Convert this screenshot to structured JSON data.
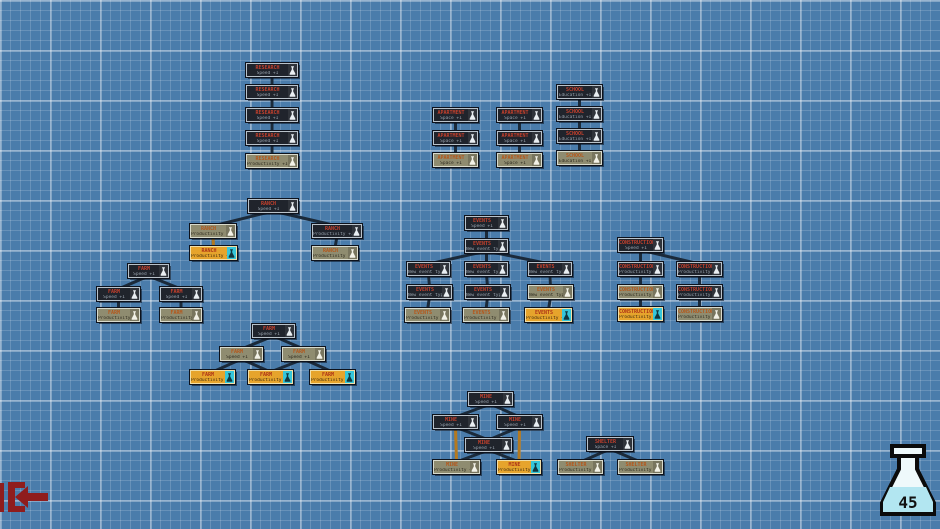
{
  "hud": {
    "science_count": "45",
    "science_icon": "flask-icon",
    "exit_icon": "exit-bracket-arrow-icon"
  },
  "palette": {
    "background_blue": "#4a7cab",
    "grid_line": "#7fa9cd",
    "node_dark_bg": "#20242c",
    "node_tan_bg": "#8f8c70",
    "node_yellow_bg": "#e6a42c",
    "node_title_red": "#c4402c",
    "node_title_orange": "#b5571a",
    "edge_dark": "#1b2a3a",
    "edge_orange": "#b5791f",
    "flask_liquid_cyan": "#b2e6f1",
    "exit_red": "#8f1d1d"
  },
  "tree": {
    "nodes": [
      {
        "id": "r1",
        "x": 246,
        "y": 63,
        "w": 52,
        "state": "dark",
        "label": "RESEARCH",
        "sub": "Speed +1"
      },
      {
        "id": "r2",
        "x": 246,
        "y": 85,
        "w": 52,
        "state": "dark",
        "label": "RESEARCH",
        "sub": "Speed +1"
      },
      {
        "id": "r3",
        "x": 246,
        "y": 108,
        "w": 52,
        "state": "dark",
        "label": "RESEARCH",
        "sub": "Speed +1"
      },
      {
        "id": "r4",
        "x": 246,
        "y": 131,
        "w": 52,
        "state": "dark",
        "label": "RESEARCH",
        "sub": "Speed +1"
      },
      {
        "id": "r5",
        "x": 246,
        "y": 154,
        "w": 52,
        "state": "tan",
        "label": "RESEARCH",
        "sub": "Productivity +10%"
      },
      {
        "id": "a1",
        "x": 433,
        "y": 108,
        "w": 45,
        "state": "dark",
        "label": "APARTMENT",
        "sub": "Space +1"
      },
      {
        "id": "a2",
        "x": 433,
        "y": 131,
        "w": 45,
        "state": "dark",
        "label": "APARTMENT",
        "sub": "Space +1"
      },
      {
        "id": "a3",
        "x": 433,
        "y": 153,
        "w": 45,
        "state": "tan",
        "label": "APARTMENT",
        "sub": "Space +1"
      },
      {
        "id": "b1",
        "x": 497,
        "y": 108,
        "w": 45,
        "state": "dark",
        "label": "APARTMENT",
        "sub": "Space +1"
      },
      {
        "id": "b2",
        "x": 497,
        "y": 131,
        "w": 45,
        "state": "dark",
        "label": "APARTMENT",
        "sub": "Space +1"
      },
      {
        "id": "b3",
        "x": 497,
        "y": 153,
        "w": 45,
        "state": "tan",
        "label": "APARTMENT",
        "sub": "Space +1"
      },
      {
        "id": "s1",
        "x": 557,
        "y": 85,
        "w": 45,
        "state": "dark",
        "label": "SCHOOL",
        "sub": "Education +1"
      },
      {
        "id": "s2",
        "x": 557,
        "y": 107,
        "w": 45,
        "state": "dark",
        "label": "SCHOOL",
        "sub": "Education +1"
      },
      {
        "id": "s3",
        "x": 557,
        "y": 129,
        "w": 45,
        "state": "dark",
        "label": "SCHOOL",
        "sub": "Education +1"
      },
      {
        "id": "s4",
        "x": 557,
        "y": 151,
        "w": 45,
        "state": "tan",
        "label": "SCHOOL",
        "sub": "Education +1"
      },
      {
        "id": "rc1",
        "x": 248,
        "y": 199,
        "w": 50,
        "state": "dark",
        "label": "RANCH",
        "sub": "Speed +1"
      },
      {
        "id": "rc2",
        "x": 190,
        "y": 224,
        "w": 46,
        "state": "tan",
        "label": "RANCH",
        "sub": "Productivity +10%"
      },
      {
        "id": "rc3",
        "x": 190,
        "y": 246,
        "w": 47,
        "state": "yellow",
        "label": "RANCH",
        "sub": "Productivity +25%"
      },
      {
        "id": "rc4",
        "x": 312,
        "y": 224,
        "w": 50,
        "state": "dark",
        "label": "RANCH",
        "sub": "Productivity +10%"
      },
      {
        "id": "rc5",
        "x": 312,
        "y": 246,
        "w": 46,
        "state": "tan",
        "label": "RANCH",
        "sub": "Productivity +10%"
      },
      {
        "id": "f1",
        "x": 128,
        "y": 264,
        "w": 41,
        "state": "dark",
        "label": "FARM",
        "sub": "Speed +1"
      },
      {
        "id": "f2",
        "x": 97,
        "y": 287,
        "w": 43,
        "state": "dark",
        "label": "FARM",
        "sub": "Speed +1"
      },
      {
        "id": "f3",
        "x": 160,
        "y": 287,
        "w": 42,
        "state": "dark",
        "label": "FARM",
        "sub": "Speed +1"
      },
      {
        "id": "f4",
        "x": 97,
        "y": 308,
        "w": 43,
        "state": "tan",
        "label": "FARM",
        "sub": "Productivity +10%"
      },
      {
        "id": "f5",
        "x": 160,
        "y": 308,
        "w": 42,
        "state": "tan",
        "label": "FARM",
        "sub": "Productivity +10%"
      },
      {
        "id": "g1",
        "x": 252,
        "y": 324,
        "w": 43,
        "state": "dark",
        "label": "FARM",
        "sub": "Speed +1"
      },
      {
        "id": "g2",
        "x": 220,
        "y": 347,
        "w": 43,
        "state": "tan",
        "label": "FARM",
        "sub": "Speed +1"
      },
      {
        "id": "g3",
        "x": 282,
        "y": 347,
        "w": 43,
        "state": "tan",
        "label": "FARM",
        "sub": "Speed +1"
      },
      {
        "id": "g4",
        "x": 190,
        "y": 370,
        "w": 45,
        "state": "yellow",
        "label": "FARM",
        "sub": "Productivity +25%"
      },
      {
        "id": "g5",
        "x": 248,
        "y": 370,
        "w": 45,
        "state": "yellow",
        "label": "FARM",
        "sub": "Productivity +25%"
      },
      {
        "id": "g6",
        "x": 310,
        "y": 370,
        "w": 45,
        "state": "yellow",
        "label": "FARM",
        "sub": "Productivity +25%"
      },
      {
        "id": "e1",
        "x": 465,
        "y": 216,
        "w": 43,
        "state": "dark",
        "label": "EVENTS",
        "sub": "Speed +1"
      },
      {
        "id": "e2",
        "x": 465,
        "y": 239,
        "w": 43,
        "state": "dark",
        "label": "EVENTS",
        "sub": "New event type"
      },
      {
        "id": "e3",
        "x": 407,
        "y": 262,
        "w": 43,
        "state": "dark",
        "label": "EVENTS",
        "sub": "New event type"
      },
      {
        "id": "e4",
        "x": 465,
        "y": 262,
        "w": 43,
        "state": "dark",
        "label": "EVENTS",
        "sub": "New event type"
      },
      {
        "id": "e5",
        "x": 528,
        "y": 262,
        "w": 44,
        "state": "dark",
        "label": "EVENTS",
        "sub": "New event type"
      },
      {
        "id": "e6",
        "x": 407,
        "y": 285,
        "w": 45,
        "state": "dark",
        "label": "EVENTS",
        "sub": "New event type"
      },
      {
        "id": "e7",
        "x": 465,
        "y": 285,
        "w": 45,
        "state": "dark",
        "label": "EVENTS",
        "sub": "New event type"
      },
      {
        "id": "e8",
        "x": 528,
        "y": 285,
        "w": 45,
        "state": "tan",
        "label": "EVENTS",
        "sub": "New event type"
      },
      {
        "id": "e9",
        "x": 405,
        "y": 308,
        "w": 45,
        "state": "tan",
        "label": "EVENTS",
        "sub": "Productivity +10%"
      },
      {
        "id": "e10",
        "x": 463,
        "y": 308,
        "w": 46,
        "state": "tan",
        "label": "EVENTS",
        "sub": "Productivity +10%"
      },
      {
        "id": "e11",
        "x": 525,
        "y": 308,
        "w": 47,
        "state": "yellow",
        "label": "EVENTS",
        "sub": "Productivity +25%"
      },
      {
        "id": "c1",
        "x": 618,
        "y": 238,
        "w": 45,
        "state": "dark",
        "label": "CONSTRUCTION",
        "sub": "Speed +1"
      },
      {
        "id": "c2",
        "x": 618,
        "y": 262,
        "w": 45,
        "state": "dark",
        "label": "CONSTRUCTION",
        "sub": "Productivity +10%"
      },
      {
        "id": "c3",
        "x": 618,
        "y": 285,
        "w": 45,
        "state": "tan",
        "label": "CONSTRUCTION",
        "sub": "Productivity +10%"
      },
      {
        "id": "c4",
        "x": 618,
        "y": 307,
        "w": 45,
        "state": "yellow",
        "label": "CONSTRUCTION",
        "sub": "Productivity +25%"
      },
      {
        "id": "c5",
        "x": 677,
        "y": 262,
        "w": 45,
        "state": "dark",
        "label": "CONSTRUCTION",
        "sub": "Productivity +10%"
      },
      {
        "id": "c6",
        "x": 677,
        "y": 285,
        "w": 45,
        "state": "dark",
        "label": "CONSTRUCTION",
        "sub": "Productivity +10%"
      },
      {
        "id": "c7",
        "x": 677,
        "y": 307,
        "w": 45,
        "state": "tan",
        "label": "CONSTRUCTION",
        "sub": "Productivity +10%"
      },
      {
        "id": "m1",
        "x": 468,
        "y": 392,
        "w": 45,
        "state": "dark",
        "label": "MINE",
        "sub": "Speed +1"
      },
      {
        "id": "m2",
        "x": 433,
        "y": 415,
        "w": 45,
        "state": "dark",
        "label": "MINE",
        "sub": "Speed +1"
      },
      {
        "id": "m3",
        "x": 497,
        "y": 415,
        "w": 45,
        "state": "dark",
        "label": "MINE",
        "sub": "Speed +1"
      },
      {
        "id": "m4",
        "x": 465,
        "y": 438,
        "w": 47,
        "state": "dark",
        "label": "MINE",
        "sub": "Speed +1"
      },
      {
        "id": "m5",
        "x": 433,
        "y": 460,
        "w": 47,
        "state": "tan",
        "label": "MINE",
        "sub": "Productivity +25%"
      },
      {
        "id": "m6",
        "x": 497,
        "y": 460,
        "w": 44,
        "state": "yellow",
        "label": "MINE",
        "sub": "Productivity +25%"
      },
      {
        "id": "sh1",
        "x": 587,
        "y": 437,
        "w": 46,
        "state": "dark",
        "label": "SHELTER",
        "sub": "Space +1"
      },
      {
        "id": "sh2",
        "x": 558,
        "y": 460,
        "w": 45,
        "state": "tan",
        "label": "SHELTER",
        "sub": "Productivity +10%"
      },
      {
        "id": "sh3",
        "x": 618,
        "y": 460,
        "w": 45,
        "state": "tan",
        "label": "SHELTER",
        "sub": "Productivity +10%"
      }
    ],
    "edges": [
      {
        "from": "r1",
        "to": "r2"
      },
      {
        "from": "r2",
        "to": "r3"
      },
      {
        "from": "r3",
        "to": "r4"
      },
      {
        "from": "r4",
        "to": "r5"
      },
      {
        "from": "a1",
        "to": "a2"
      },
      {
        "from": "a2",
        "to": "a3"
      },
      {
        "from": "b1",
        "to": "b2"
      },
      {
        "from": "b2",
        "to": "b3"
      },
      {
        "from": "s1",
        "to": "s2"
      },
      {
        "from": "s2",
        "to": "s3"
      },
      {
        "from": "s3",
        "to": "s4"
      },
      {
        "from": "rc1",
        "to": "rc2"
      },
      {
        "from": "rc1",
        "to": "rc4"
      },
      {
        "from": "rc2",
        "to": "rc3",
        "tone": "orange"
      },
      {
        "from": "rc4",
        "to": "rc5"
      },
      {
        "from": "f1",
        "to": "f2"
      },
      {
        "from": "f1",
        "to": "f3"
      },
      {
        "from": "f2",
        "to": "f4"
      },
      {
        "from": "f3",
        "to": "f5"
      },
      {
        "from": "g1",
        "to": "g2"
      },
      {
        "from": "g1",
        "to": "g3"
      },
      {
        "from": "g2",
        "to": "g4"
      },
      {
        "from": "g2",
        "to": "g5"
      },
      {
        "from": "g3",
        "to": "g5"
      },
      {
        "from": "g3",
        "to": "g6"
      },
      {
        "from": "e1",
        "to": "e2"
      },
      {
        "from": "e2",
        "to": "e3"
      },
      {
        "from": "e2",
        "to": "e4"
      },
      {
        "from": "e2",
        "to": "e5"
      },
      {
        "from": "e3",
        "to": "e6"
      },
      {
        "from": "e4",
        "to": "e7"
      },
      {
        "from": "e5",
        "to": "e8"
      },
      {
        "from": "e6",
        "to": "e9"
      },
      {
        "from": "e7",
        "to": "e10"
      },
      {
        "from": "e8",
        "to": "e11"
      },
      {
        "from": "c1",
        "to": "c2"
      },
      {
        "from": "c1",
        "to": "c5"
      },
      {
        "from": "c2",
        "to": "c3"
      },
      {
        "from": "c3",
        "to": "c4"
      },
      {
        "from": "c5",
        "to": "c6"
      },
      {
        "from": "c6",
        "to": "c7"
      },
      {
        "from": "m1",
        "to": "m2"
      },
      {
        "from": "m1",
        "to": "m3"
      },
      {
        "from": "m2",
        "to": "m4"
      },
      {
        "from": "m3",
        "to": "m4"
      },
      {
        "from": "m2",
        "to": "m5",
        "tone": "orange"
      },
      {
        "from": "m3",
        "to": "m6",
        "tone": "orange"
      },
      {
        "from": "m4",
        "to": "m5"
      },
      {
        "from": "m4",
        "to": "m6"
      },
      {
        "from": "sh1",
        "to": "sh2"
      },
      {
        "from": "sh1",
        "to": "sh3"
      }
    ]
  }
}
